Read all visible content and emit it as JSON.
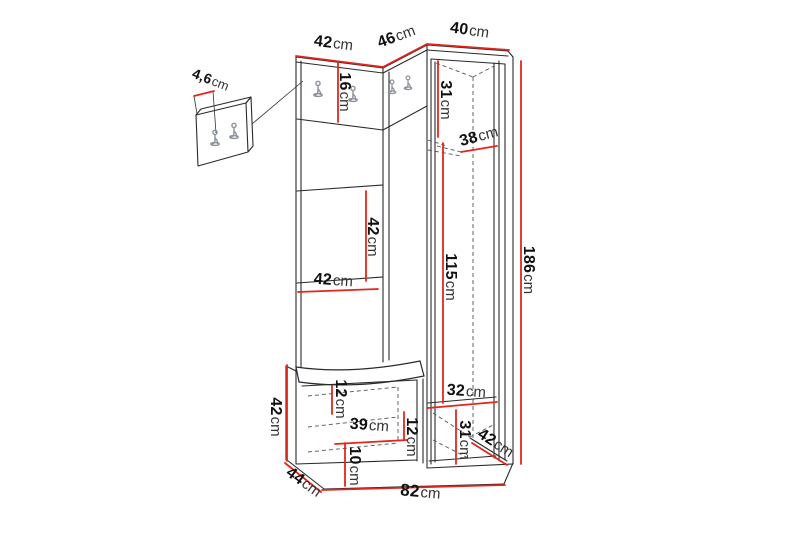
{
  "diagram": {
    "description": "Hallway furniture set dimension drawing",
    "unit_symbol": "cm",
    "colors": {
      "dimension_line": "#e2261c",
      "line_art": "#1f1f1f",
      "background": "#ffffff"
    },
    "dimensions": [
      {
        "id": "top-left-section-width",
        "value": "42",
        "unit": "cm"
      },
      {
        "id": "corner-panel-width",
        "value": "46",
        "unit": "cm"
      },
      {
        "id": "cabinet-width",
        "value": "40",
        "unit": "cm"
      },
      {
        "id": "wall-panel-thickness",
        "value": "4,6",
        "unit": "cm"
      },
      {
        "id": "hook-panel-height",
        "value": "16",
        "unit": "cm"
      },
      {
        "id": "cabinet-top-interior-height",
        "value": "31",
        "unit": "cm"
      },
      {
        "id": "cabinet-interior-depth",
        "value": "38",
        "unit": "cm"
      },
      {
        "id": "middle-section-height",
        "value": "42",
        "unit": "cm"
      },
      {
        "id": "middle-section-width",
        "value": "42",
        "unit": "cm"
      },
      {
        "id": "cabinet-interior-height",
        "value": "115",
        "unit": "cm"
      },
      {
        "id": "total-height",
        "value": "186",
        "unit": "cm"
      },
      {
        "id": "bench-height",
        "value": "42",
        "unit": "cm"
      },
      {
        "id": "bench-top-interior-height",
        "value": "12",
        "unit": "cm"
      },
      {
        "id": "bench-interior-width",
        "value": "39",
        "unit": "cm"
      },
      {
        "id": "bench-interior-height",
        "value": "12",
        "unit": "cm"
      },
      {
        "id": "bench-bottom-interior-height",
        "value": "10",
        "unit": "cm"
      },
      {
        "id": "cabinet-bottom-interior-width",
        "value": "32",
        "unit": "cm"
      },
      {
        "id": "cabinet-bottom-interior-height",
        "value": "31",
        "unit": "cm"
      },
      {
        "id": "cabinet-depth",
        "value": "42",
        "unit": "cm"
      },
      {
        "id": "bench-depth",
        "value": "44",
        "unit": "cm"
      },
      {
        "id": "total-width",
        "value": "82",
        "unit": "cm"
      }
    ]
  }
}
